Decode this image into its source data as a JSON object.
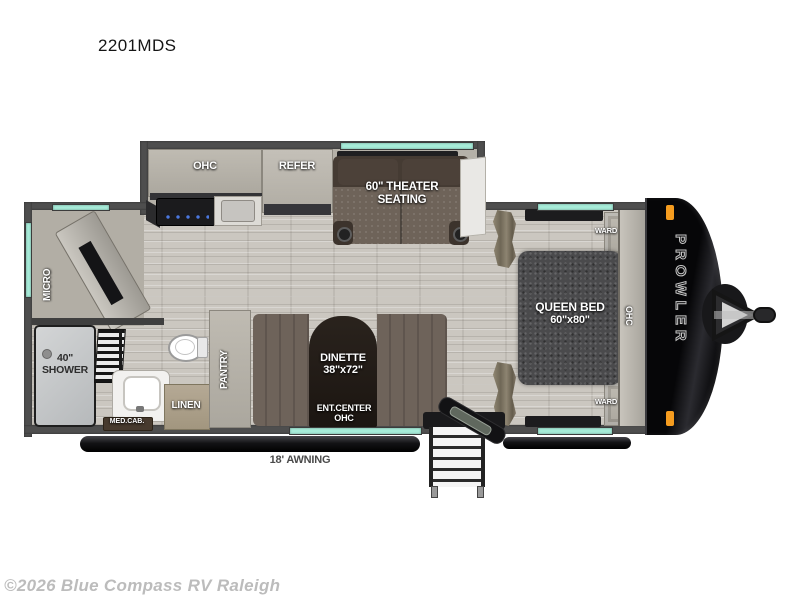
{
  "page": {
    "title": "2201MDS",
    "copyright": "©2026 Blue Compass RV Raleigh"
  },
  "floorplan": {
    "brand": "PROWLER",
    "awning_label": "18' AWNING",
    "kitchen": {
      "ohc_label": "OHC",
      "refer_label": "REFER"
    },
    "theater": {
      "label_line1": "60\" THEATER",
      "label_line2": "SEATING"
    },
    "galley": {
      "micro_label": "MICRO"
    },
    "bathroom": {
      "shower_line1": "40\"",
      "shower_line2": "SHOWER",
      "med_cab_label": "MED.CAB.",
      "linen_label": "LINEN"
    },
    "pantry_label": "PANTRY",
    "dinette": {
      "label_line1": "DINETTE",
      "label_line2": "38\"x72\"",
      "ent_center_line1": "ENT.CENTER",
      "ent_center_line2": "OHC"
    },
    "bedroom": {
      "bed_line1": "QUEEN BED",
      "bed_line2": "60\"x80\"",
      "ward_top_label": "WARD",
      "ward_bottom_label": "WARD",
      "ohc_label": "OHC"
    },
    "colors": {
      "window_glass": "#a7ecd9",
      "wall": "#4e4e4e",
      "front_cap": "#0d0d0f",
      "marker_light": "#f59c1f",
      "floor_wood": "#cbc7c0",
      "theater_sofa": "#6e6359",
      "bed_fabric": "#4a4a4c"
    }
  }
}
